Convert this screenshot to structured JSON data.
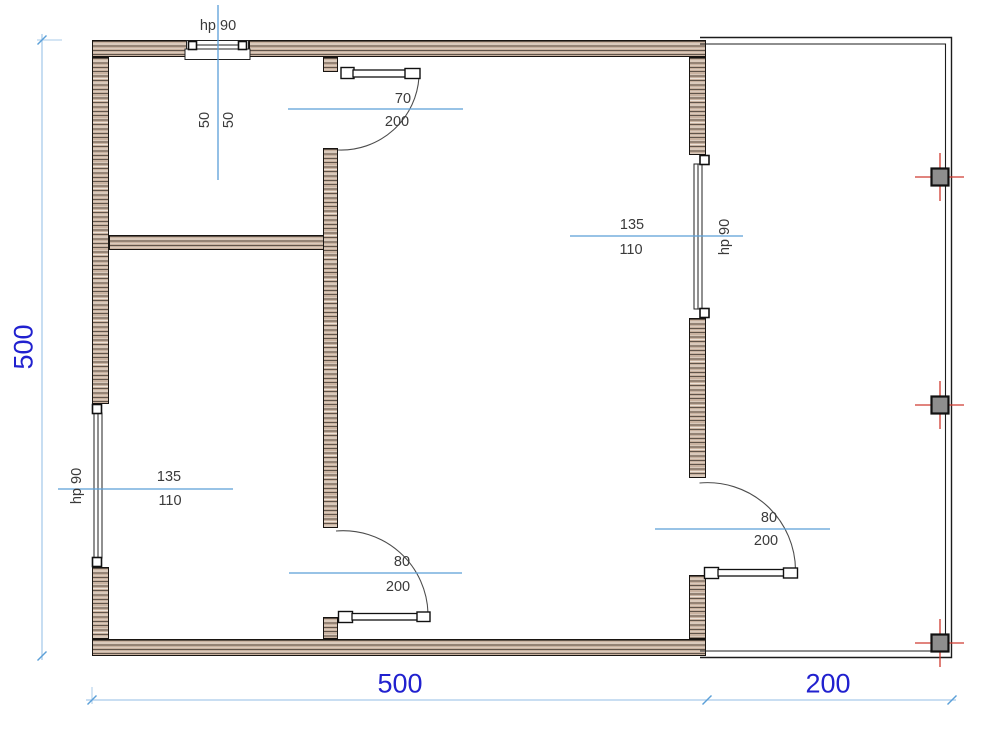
{
  "plan": {
    "overall_dims": {
      "height_total": "500",
      "width_main": "500",
      "width_porch": "200"
    },
    "top_window": {
      "hp": "hp 90",
      "w": "50",
      "h": "50"
    },
    "top_door": {
      "w": "70",
      "h": "200"
    },
    "right_window": {
      "w": "135",
      "h": "110",
      "hp": "hp 90"
    },
    "left_window": {
      "w": "135",
      "h": "110",
      "hp": "hp 90"
    },
    "mid_door": {
      "w": "80",
      "h": "200"
    },
    "right_door": {
      "w": "80",
      "h": "200"
    },
    "colors": {
      "dim_text": "#2121cf",
      "dim_line": "#a9cbea",
      "fraction_line": "#5b9fd8",
      "annotation_text": "#3a3a3a",
      "wall_fill": "#c9b2a0",
      "column_fill": "#8e8e8e",
      "axis_red": "#cf3a30"
    }
  }
}
